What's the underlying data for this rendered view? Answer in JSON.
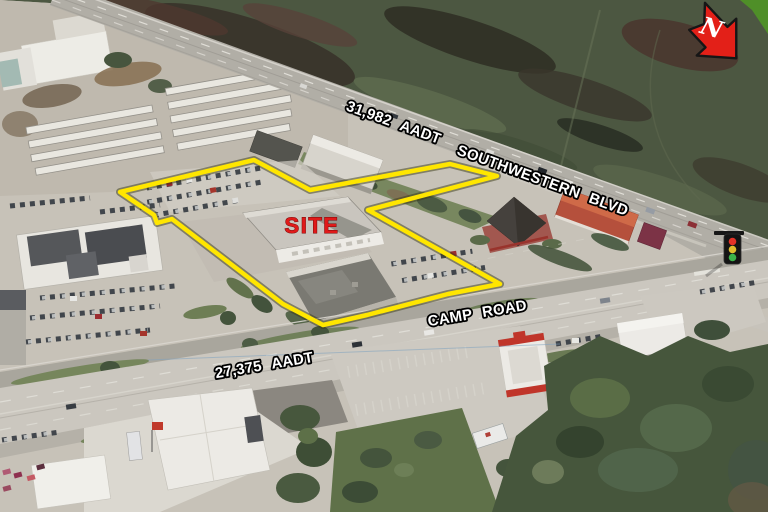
{
  "site": {
    "label": "SITE",
    "label_color": "#e01a1a",
    "outline_color": "#ffe600"
  },
  "roads": {
    "southwestern_blvd": {
      "name": "SOUTHWESTERN BLVD",
      "aadt": "31,982 AADT"
    },
    "camp_road": {
      "name": "CAMP ROAD",
      "aadt": "27,375 AADT"
    }
  },
  "compass": {
    "label": "N",
    "arrow_color": "#e32018"
  },
  "icons": {
    "north_arrow": "north-arrow",
    "traffic_light": "traffic-light"
  }
}
